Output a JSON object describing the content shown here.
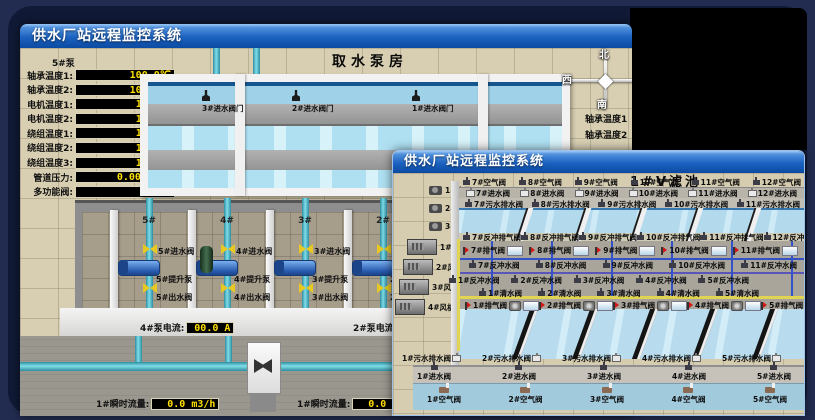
{
  "scene": {
    "background": "#222c50",
    "panel": "#101a36",
    "black_window": "#000000",
    "titlebar_top": "#9cc8f8",
    "titlebar_bottom": "#0b4aa2",
    "led_text": "#ffdf00",
    "pipe_cyan": "#7fdde9",
    "valve_yellow": "#e8c822",
    "pump_blue": "#2a5cb0"
  },
  "window1": {
    "title": "供水厂站远程监控系统",
    "room_title": "取水泵房",
    "pump_panel": {
      "header": "5#泵",
      "rows": [
        {
          "label": "轴承温度1:",
          "value": "100.0℃"
        },
        {
          "label": "轴承温度2:",
          "value": "100.0℃"
        },
        {
          "label": "电机温度1:",
          "value": "18.1℃"
        },
        {
          "label": "电机温度2:",
          "value": "17.9℃"
        },
        {
          "label": "绕组温度1:",
          "value": "18.0℃"
        },
        {
          "label": "绕组温度2:",
          "value": "18.1℃"
        },
        {
          "label": "绕组温度3:",
          "value": "18.1℃"
        },
        {
          "label": "管道压力:",
          "value": "0.0007MPa"
        },
        {
          "label": "多功能阀:",
          "value": "0%"
        }
      ]
    },
    "intake_valves": [
      "3#进水阀门",
      "2#进水阀门",
      "1#进水阀门"
    ],
    "compass": {
      "north": "北",
      "south": "南",
      "west": "西",
      "east": "东"
    },
    "side_labels": [
      "轴承温度1",
      "轴承温度2"
    ],
    "bays": [
      {
        "no": "5#",
        "inlet": "5#进水阀",
        "pump": "5#提升泵",
        "outlet": "5#出水阀"
      },
      {
        "no": "4#",
        "inlet": "4#进水阀",
        "pump": "4#提升泵",
        "outlet": "4#出水阀"
      },
      {
        "no": "3#",
        "inlet": "3#进水阀",
        "pump": "3#提升泵",
        "outlet": "3#出水阀"
      },
      {
        "no": "2#",
        "inlet": "2#进水阀",
        "pump": "2#提升泵",
        "outlet": "2#出水阀"
      }
    ],
    "current_readouts": [
      {
        "label": "4#泵电流:",
        "value": "00.0 A"
      },
      {
        "label": "2#泵电流:",
        "value": ""
      }
    ],
    "flow_readouts": [
      {
        "label": "1#瞬时流量:",
        "value": "0.0 m3/h"
      },
      {
        "label": "1#瞬时流量:",
        "value": "0.0 m3/h"
      }
    ]
  },
  "window2": {
    "title": "供水厂站远程监控系统",
    "room_title": "1#V滤池",
    "pumps": [
      "1#水泵",
      "2#水泵",
      "3#水泵"
    ],
    "blowers": [
      "1#风机",
      "2#风机",
      "3#风机",
      "4#风机"
    ],
    "rows": {
      "air_top": [
        "7#空气阀",
        "8#空气阀",
        "9#空气阀",
        "10#空气阀",
        "11#空气阀",
        "12#空气阀"
      ],
      "inlet_top": [
        "7#进水阀",
        "8#进水阀",
        "9#进水阀",
        "10#进水阀",
        "11#进水阀",
        "12#进水阀"
      ],
      "drain_top": [
        "7#污水排水阀",
        "8#污水排水阀",
        "9#污水排水阀",
        "10#污水排水阀",
        "11#污水排水阀"
      ],
      "backwash_exhaust_top": [
        "7#反冲排气阀",
        "8#反冲排气阀",
        "9#反冲排气阀",
        "10#反冲排气阀",
        "11#反冲排气阀",
        "12#反冲排气阀"
      ],
      "exhaust_top": [
        "7#排气阀",
        "8#排气阀",
        "9#排气阀",
        "10#排气阀",
        "11#排气阀"
      ],
      "backwash_top": [
        "7#反冲水阀",
        "8#反冲水阀",
        "9#反冲水阀",
        "10#反冲水阀",
        "11#反冲水阀"
      ],
      "backwash_bottom": [
        "1#反冲水阀",
        "2#反冲水阀",
        "3#反冲水阀",
        "4#反冲水阀",
        "5#反冲水阀"
      ],
      "clean_bottom": [
        "1#清水阀",
        "2#清水阀",
        "3#清水阀",
        "4#清水阀",
        "5#清水阀"
      ],
      "exhaust_bottom": [
        "1#排气阀",
        "2#排气阀",
        "3#排气阀",
        "4#排气阀",
        "5#排气阀"
      ],
      "drain_bottom": [
        "1#污水排水阀",
        "2#污水排水阀",
        "3#污水排水阀",
        "4#污水排水阀",
        "5#污水排水阀"
      ],
      "inlet_bottom": [
        "1#进水阀",
        "2#进水阀",
        "3#进水阀",
        "4#进水阀",
        "5#进水阀"
      ],
      "air_bottom": [
        "1#空气阀",
        "2#空气阀",
        "3#空气阀",
        "4#空气阀",
        "5#空气阀"
      ]
    }
  }
}
